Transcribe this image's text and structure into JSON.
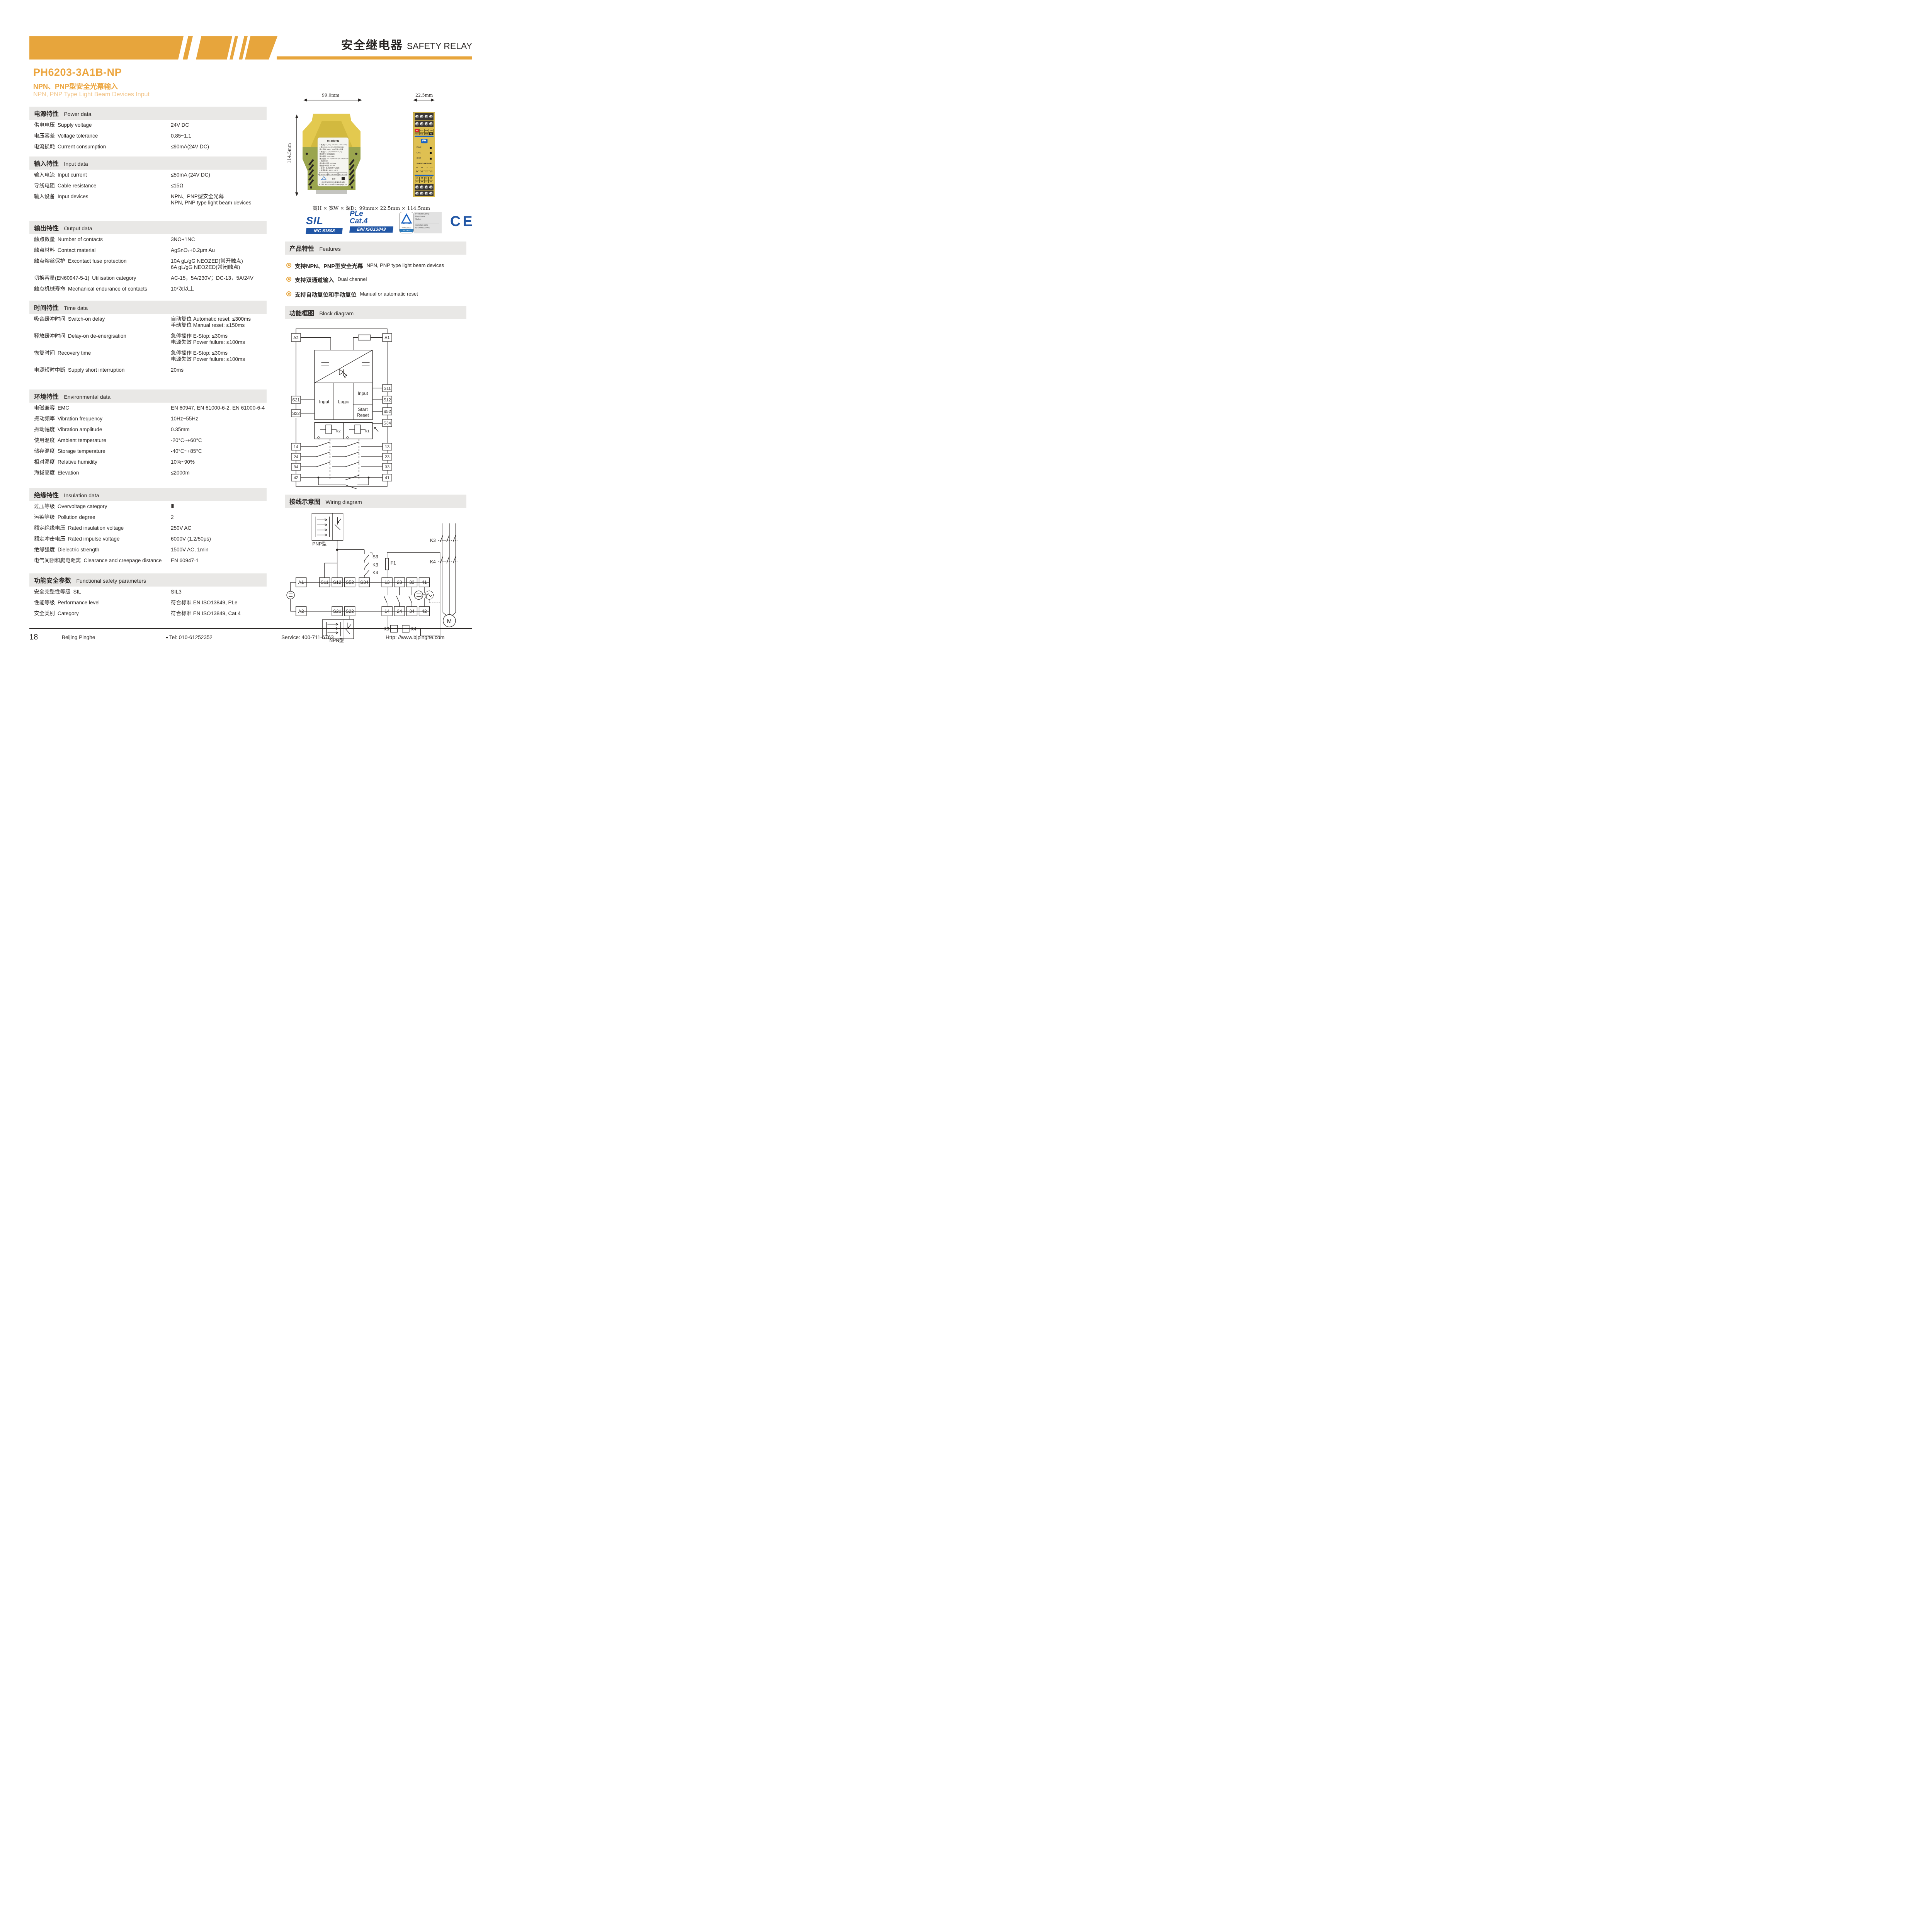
{
  "header": {
    "title_cn": "安全继电器",
    "title_en": "SAFETY RELAY"
  },
  "product": {
    "model": "PH6203-3A1B-NP",
    "subtitle_cn": "NPN、PNP型安全光幕输入",
    "subtitle_en": "NPN, PNP Type Light Beam Devices Input"
  },
  "dimensions": {
    "width": "99.0mm",
    "depth": "22.5mm",
    "height": "114.5mm",
    "summary": "高H × 宽W × 深D：99mm× 22.5mm × 114.5mm"
  },
  "sections": {
    "power": {
      "title_cn": "电源特性",
      "title_en": "Power data",
      "rows": [
        {
          "cn": "供电电压",
          "en": "Supply voltage",
          "v": [
            "24V DC"
          ]
        },
        {
          "cn": "电压容差",
          "en": "Voltage tolerance",
          "v": [
            "0.85~1.1"
          ]
        },
        {
          "cn": "电流损耗",
          "en": "Current consumption",
          "v": [
            "≤90mA(24V DC)"
          ]
        }
      ]
    },
    "input": {
      "title_cn": "输入特性",
      "title_en": "Input data",
      "rows": [
        {
          "cn": "输入电流",
          "en": "Input current",
          "v": [
            "≤50mA (24V DC)"
          ]
        },
        {
          "cn": "导线电阻",
          "en": "Cable resistance",
          "v": [
            "≤15Ω"
          ]
        },
        {
          "cn": "输入设备",
          "en": "Input devices",
          "v": [
            "NPN、PNP型安全光幕",
            "NPN, PNP type light beam devices"
          ]
        }
      ]
    },
    "output": {
      "title_cn": "输出特性",
      "title_en": "Output data",
      "rows": [
        {
          "cn": "触点数量",
          "en": "Number of contacts",
          "v": [
            "3NO+1NC"
          ]
        },
        {
          "cn": "触点材料",
          "en": "Contact material",
          "v": [
            "AgSnO₂+0.2μm Au"
          ]
        },
        {
          "cn": "触点熔丝保护",
          "en": "Excontact fuse protection",
          "v": [
            "10A gL/gG NEOZED(常开触点)",
            "6A gL/gG NEOZED(常闭触点)"
          ]
        },
        {
          "cn": "切换容量(EN60947-5-1)",
          "en": "Utilisation category",
          "v": [
            "AC-15，5A/230V；DC-13，5A/24V"
          ]
        },
        {
          "cn": "触点机械寿命",
          "en": "Mechanical endurance of contacts",
          "v": [
            "10⁷次以上"
          ]
        }
      ]
    },
    "time": {
      "title_cn": "时间特性",
      "title_en": "Time data",
      "rows": [
        {
          "cn": "吸合缓冲时间",
          "en": "Switch-on delay",
          "v": [
            "自动复位 Automatic reset: ≤300ms",
            "手动复位 Manual reset: ≤150ms"
          ]
        },
        {
          "cn": "释放缓冲时间",
          "en": "Delay-on de-energisation",
          "v": [
            "急停操作 E-Stop: ≤30ms",
            "电源失效 Power failure: ≤100ms"
          ]
        },
        {
          "cn": "恢复时间",
          "en": "Recovery time",
          "v": [
            "急停操作 E-Stop: ≤30ms",
            "电源失效 Power failure: ≤100ms"
          ]
        },
        {
          "cn": "电源短时中断",
          "en": "Supply short interruption",
          "v": [
            "20ms"
          ]
        }
      ]
    },
    "environment": {
      "title_cn": "环境特性",
      "title_en": "Environmental data",
      "rows": [
        {
          "cn": "电磁兼容",
          "en": "EMC",
          "v": [
            "EN 60947, EN 61000-6-2, EN 61000-6-4"
          ]
        },
        {
          "cn": "振动频率",
          "en": "Vibration frequency",
          "v": [
            "10Hz~55Hz"
          ]
        },
        {
          "cn": "振动幅度",
          "en": "Vibration amplitude",
          "v": [
            "0.35mm"
          ]
        },
        {
          "cn": "使用温度",
          "en": "Ambient temperature",
          "v": [
            "-20°C~+60°C"
          ]
        },
        {
          "cn": "储存温度",
          "en": "Storage temperature",
          "v": [
            "-40°C~+85°C"
          ]
        },
        {
          "cn": "相对湿度",
          "en": "Relative humidity",
          "v": [
            "10%~90%"
          ]
        },
        {
          "cn": "海拔高度",
          "en": "Elevation",
          "v": [
            "≤2000m"
          ]
        }
      ]
    },
    "insulation": {
      "title_cn": "绝缘特性",
      "title_en": "Insulation data",
      "rows": [
        {
          "cn": "过压等级",
          "en": "Overvoltage category",
          "v": [
            "Ⅲ"
          ]
        },
        {
          "cn": "污染等级",
          "en": "Pollution degree",
          "v": [
            "2"
          ]
        },
        {
          "cn": "额定绝缘电压",
          "en": "Rated insulation voltage",
          "v": [
            "250V AC"
          ]
        },
        {
          "cn": "额定冲击电压",
          "en": "Rated impulse voltage",
          "v": [
            "6000V (1.2/50μs)"
          ]
        },
        {
          "cn": "绝缘强度",
          "en": "Dielectric strength",
          "v": [
            "1500V AC, 1min"
          ]
        },
        {
          "cn": "电气间隙和爬电距离",
          "en": "Clearance and creepage distance",
          "v": [
            "EN 60947-1"
          ]
        }
      ]
    },
    "safety": {
      "title_cn": "功能安全参数",
      "title_en": "Functional safety parameters",
      "rows": [
        {
          "cn": "安全完整性等级",
          "en": "SIL",
          "v": [
            "SIL3"
          ]
        },
        {
          "cn": "性能等级",
          "en": "Performance level",
          "v": [
            "符合标准  EN ISO13849, PLe"
          ]
        },
        {
          "cn": "安全类别",
          "en": "Category",
          "v": [
            "符合标准  EN ISO13849, Cat.4"
          ]
        }
      ]
    }
  },
  "badges": {
    "sil": "SIL",
    "sil_std": "IEC 61508",
    "ple": "PLe",
    "cat": "Cat.4",
    "ple_std": "EN/ ISO13849",
    "tuv_name": "TÜVRheinland",
    "tuv_cert": "CERTIFIED",
    "tuv_line1": "Product Safety",
    "tuv_line2": "Functional",
    "tuv_line3": "Safety",
    "tuv_url": "www.tuv.com",
    "tuv_id": "ID 0600000000",
    "ce": "CE",
    "blue": "#2156A5"
  },
  "features": {
    "title_cn": "产品特性",
    "title_en": "Features",
    "items": [
      {
        "cn": "支持NPN、PNP型安全光幕",
        "en": "NPN, PNP type light beam devices"
      },
      {
        "cn": "支持双通道输入",
        "en": "Dual channel"
      },
      {
        "cn": "支持自动复位和手动复位",
        "en": "Manual or automatic reset"
      }
    ]
  },
  "device_front": {
    "top_labels": [
      [
        "A1",
        "S22",
        "S21",
        "S52"
      ],
      [
        "S34",
        "S12",
        "S11",
        "A2"
      ]
    ],
    "leds": [
      "PWR",
      "CH1",
      "CH2"
    ],
    "model": "PH6203-3A1B-NP",
    "contact_top": [
      "41",
      "33",
      "13",
      "23"
    ],
    "contact_bottom": [
      "42",
      "34",
      "14",
      "24"
    ],
    "table": [
      [
        "41",
        "33",
        "13",
        "14"
      ],
      [
        "42",
        "34",
        "23",
        "24"
      ]
    ],
    "logo": "PH"
  },
  "device_side": {
    "logo_line": "PH 北京平和",
    "label_lines": [
      "● 电源(A1+,A2-)：24V DC(-15%~+10%)",
      "● 输入(S11,S12,S21,S22,S34,S52)：",
      "   输入设备：NPN、PNP型安全光幕",
      "● 输出(13,14,23,24,33,34,41,42)：",
      "   输出信号：继电器输出",
      "   触点数量：3NO+1NC",
      "   触点容量：AC-15,5A/230V;DC-13,5A/24V",
      "● 响应时间：",
      "   吸合缓冲时间：≤300ms",
      "   释放缓冲时间：≤30ms",
      "● 复位：自动复位和手动复位",
      "● 使用温度：-20°C~+60°C"
    ],
    "cert_boxes": [
      "SIL3 SC3 IEC 61508",
      "PL e ISO 13849",
      "Cat 4 ISO 13849"
    ],
    "ce": "CE",
    "company": "北京平和创业科技发展有限公司",
    "support": "技术支持: 400-711-6763  网址: www.bjpinghe.com"
  },
  "block_diagram": {
    "title_cn": "功能框图",
    "title_en": "Block diagram",
    "terminals": {
      "a2": "A2",
      "a1": "A1",
      "s21": "S21",
      "s22": "S22",
      "s11": "S11",
      "s12": "S12",
      "s52": "S52",
      "s34": "S34",
      "c14": "14",
      "c24": "24",
      "c34": "34",
      "c42": "42",
      "c13": "13",
      "c23": "23",
      "c33": "33",
      "c41": "41"
    },
    "labels": {
      "input_left": "Input",
      "logic": "Logic",
      "input_right": "Input",
      "start": "Start",
      "reset": "Reset",
      "k2": "K2",
      "k1": "K1"
    }
  },
  "wiring_diagram": {
    "title_cn": "接线示意图",
    "title_en": "Wiring diagram",
    "labels": {
      "pnp": "PNP型",
      "npn": "NPN型",
      "s3": "S3",
      "k3": "K3",
      "k4": "K4",
      "f1": "F1",
      "k3_contacts": "K3",
      "k4_contacts": "K4",
      "k3_coil": "K3",
      "k4_coil": "K4",
      "motor": "M"
    },
    "row1": [
      "A1",
      "S11",
      "S12",
      "S52",
      "S34",
      "13",
      "23",
      "33",
      "41"
    ],
    "row2": [
      "A2",
      "S21",
      "S22",
      "14",
      "24",
      "34",
      "42"
    ]
  },
  "footer": {
    "page": "18",
    "company": "Beijing Pinghe",
    "tel": "Tel: 010-61252352",
    "service": "Service: 400-711-6763",
    "web": "Http: //www.bjpinghe.com"
  }
}
